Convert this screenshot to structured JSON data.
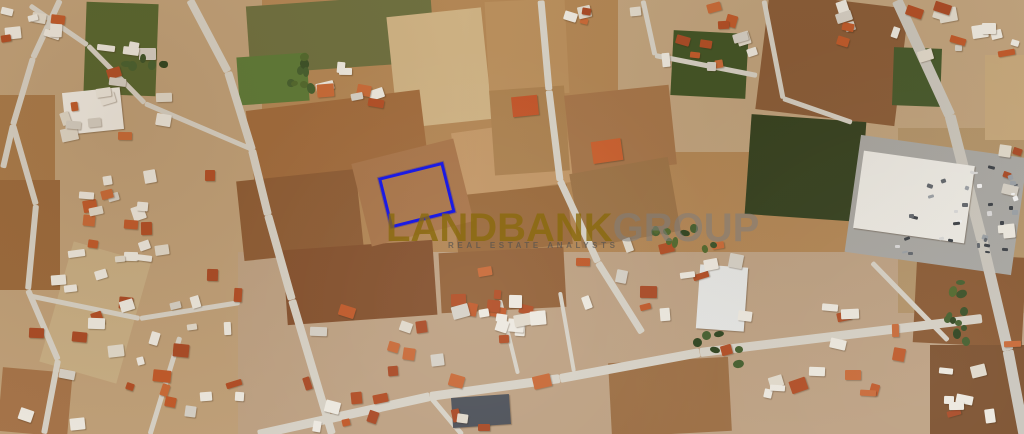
{
  "watermark": {
    "brand_primary": "LANDBANK",
    "brand_secondary": "GROUP",
    "tagline": "REAL ESTATE ANALYSTS",
    "primary_color": "rgba(138,106,12,0.8)",
    "secondary_color": "rgba(125,125,125,0.55)"
  },
  "annotation": {
    "plot_outline_color": "#1b1be4",
    "plot": {
      "x": 378,
      "y": 178,
      "w": 61,
      "h": 46,
      "r": -14
    }
  },
  "map": {
    "type": "satellite-aerial",
    "base_color": "#b28655",
    "road_color": "#d6d1c6",
    "fields": [
      {
        "x": 0,
        "y": 0,
        "w": 262,
        "h": 434,
        "r": 0,
        "c": "#bfa079"
      },
      {
        "x": 238,
        "y": 252,
        "w": 790,
        "h": 182,
        "r": 0,
        "c": "#bda183"
      },
      {
        "x": 618,
        "y": 0,
        "w": 406,
        "h": 152,
        "r": 0,
        "c": "#c0a37e"
      },
      {
        "x": 898,
        "y": 128,
        "w": 126,
        "h": 185,
        "r": 0,
        "c": "#b3946a"
      },
      {
        "x": 85,
        "y": 3,
        "w": 72,
        "h": 92,
        "r": 2,
        "c": "#55652f"
      },
      {
        "x": 0,
        "y": 95,
        "w": 55,
        "h": 85,
        "r": 0,
        "c": "#a87a4a"
      },
      {
        "x": 0,
        "y": 180,
        "w": 60,
        "h": 110,
        "r": 0,
        "c": "#9b6a3d",
        "tx": "rows-h"
      },
      {
        "x": 248,
        "y": 0,
        "w": 185,
        "h": 68,
        "r": -4,
        "c": "#6e7040"
      },
      {
        "x": 238,
        "y": 55,
        "w": 70,
        "h": 48,
        "r": -4,
        "c": "#5d7a38"
      },
      {
        "x": 392,
        "y": 12,
        "w": 95,
        "h": 112,
        "r": -6,
        "c": "#cdb183",
        "tx": "contour"
      },
      {
        "x": 487,
        "y": 0,
        "w": 80,
        "h": 95,
        "r": -3,
        "c": "#b98f5d"
      },
      {
        "x": 250,
        "y": 100,
        "w": 175,
        "h": 80,
        "r": -7,
        "c": "#a06b3d"
      },
      {
        "x": 240,
        "y": 175,
        "w": 120,
        "h": 80,
        "r": -6,
        "c": "#8d5c35",
        "tx": "rows-h"
      },
      {
        "x": 455,
        "y": 125,
        "w": 115,
        "h": 65,
        "r": -8,
        "c": "#c29767"
      },
      {
        "x": 492,
        "y": 88,
        "w": 75,
        "h": 85,
        "r": -4,
        "c": "#ab8150",
        "tx": "dots"
      },
      {
        "x": 455,
        "y": 190,
        "w": 115,
        "h": 60,
        "r": -6,
        "c": "#9a6a3c"
      },
      {
        "x": 285,
        "y": 245,
        "w": 150,
        "h": 75,
        "r": -4,
        "c": "#84512e"
      },
      {
        "x": 440,
        "y": 250,
        "w": 125,
        "h": 60,
        "r": -3,
        "c": "#936239"
      },
      {
        "x": 568,
        "y": 90,
        "w": 105,
        "h": 80,
        "r": -6,
        "c": "#a5754a"
      },
      {
        "x": 575,
        "y": 165,
        "w": 100,
        "h": 75,
        "r": -10,
        "c": "#9c7347",
        "tx": "contour"
      },
      {
        "x": 672,
        "y": 32,
        "w": 75,
        "h": 65,
        "r": 3,
        "c": "#415426"
      },
      {
        "x": 762,
        "y": 0,
        "w": 140,
        "h": 118,
        "r": 7,
        "c": "#8a5c38",
        "tx": "rows-v"
      },
      {
        "x": 748,
        "y": 118,
        "w": 115,
        "h": 100,
        "r": 4,
        "c": "#33401f"
      },
      {
        "x": 893,
        "y": 48,
        "w": 48,
        "h": 58,
        "r": 2,
        "c": "#46592c"
      },
      {
        "x": 985,
        "y": 55,
        "w": 39,
        "h": 85,
        "r": 0,
        "c": "#c6a87c"
      },
      {
        "x": 55,
        "y": 250,
        "w": 80,
        "h": 125,
        "r": 16,
        "c": "#c7ae85",
        "tx": "rows-h"
      },
      {
        "x": 0,
        "y": 370,
        "w": 70,
        "h": 64,
        "r": 5,
        "c": "#a5744a"
      },
      {
        "x": 915,
        "y": 255,
        "w": 109,
        "h": 90,
        "r": 3,
        "c": "#8a5a34"
      },
      {
        "x": 930,
        "y": 345,
        "w": 94,
        "h": 89,
        "r": 0,
        "c": "#7d5230",
        "tx": "rows-v"
      },
      {
        "x": 610,
        "y": 360,
        "w": 120,
        "h": 74,
        "r": -3,
        "c": "#9c6f45"
      },
      {
        "x": 360,
        "y": 150,
        "w": 105,
        "h": 85,
        "r": -14,
        "c": "#a8754a",
        "tx": "rows-v"
      },
      {
        "x": 852,
        "y": 146,
        "w": 168,
        "h": 118,
        "r": 8,
        "c": "#a8a7a3"
      }
    ],
    "roads": [
      {
        "x1": 190,
        "y1": 0,
        "x2": 228,
        "y2": 72,
        "t": 8
      },
      {
        "x1": 228,
        "y1": 72,
        "x2": 252,
        "y2": 150,
        "t": 8
      },
      {
        "x1": 252,
        "y1": 150,
        "x2": 268,
        "y2": 215,
        "t": 8
      },
      {
        "x1": 268,
        "y1": 215,
        "x2": 292,
        "y2": 300,
        "t": 8
      },
      {
        "x1": 292,
        "y1": 300,
        "x2": 332,
        "y2": 434,
        "t": 8
      },
      {
        "x1": 541,
        "y1": 0,
        "x2": 549,
        "y2": 90,
        "t": 7
      },
      {
        "x1": 549,
        "y1": 90,
        "x2": 560,
        "y2": 180,
        "t": 7
      },
      {
        "x1": 560,
        "y1": 180,
        "x2": 598,
        "y2": 262,
        "t": 7
      },
      {
        "x1": 598,
        "y1": 262,
        "x2": 642,
        "y2": 332,
        "t": 7
      },
      {
        "x1": 897,
        "y1": 0,
        "x2": 950,
        "y2": 115,
        "t": 11,
        "c": "#cac6bd"
      },
      {
        "x1": 950,
        "y1": 115,
        "x2": 982,
        "y2": 240,
        "t": 11,
        "c": "#cac6bd"
      },
      {
        "x1": 982,
        "y1": 240,
        "x2": 1008,
        "y2": 350,
        "t": 11,
        "c": "#cac6bd"
      },
      {
        "x1": 1008,
        "y1": 350,
        "x2": 1024,
        "y2": 434,
        "t": 11,
        "c": "#cac6bd"
      },
      {
        "x1": 258,
        "y1": 434,
        "x2": 430,
        "y2": 396,
        "t": 9
      },
      {
        "x1": 430,
        "y1": 396,
        "x2": 560,
        "y2": 378,
        "t": 9
      },
      {
        "x1": 560,
        "y1": 378,
        "x2": 700,
        "y2": 352,
        "t": 9
      },
      {
        "x1": 700,
        "y1": 352,
        "x2": 982,
        "y2": 318,
        "t": 9
      },
      {
        "x1": 430,
        "y1": 396,
        "x2": 462,
        "y2": 434,
        "t": 5
      },
      {
        "x1": 60,
        "y1": 0,
        "x2": 33,
        "y2": 58,
        "t": 6
      },
      {
        "x1": 33,
        "y1": 58,
        "x2": 13,
        "y2": 125,
        "t": 6
      },
      {
        "x1": 13,
        "y1": 125,
        "x2": 3,
        "y2": 168,
        "t": 6
      },
      {
        "x1": 30,
        "y1": 5,
        "x2": 88,
        "y2": 45,
        "t": 5
      },
      {
        "x1": 88,
        "y1": 45,
        "x2": 145,
        "y2": 103,
        "t": 5
      },
      {
        "x1": 145,
        "y1": 103,
        "x2": 250,
        "y2": 148,
        "t": 5
      },
      {
        "x1": 13,
        "y1": 125,
        "x2": 36,
        "y2": 205,
        "t": 6
      },
      {
        "x1": 36,
        "y1": 205,
        "x2": 28,
        "y2": 290,
        "t": 6
      },
      {
        "x1": 28,
        "y1": 290,
        "x2": 58,
        "y2": 360,
        "t": 6
      },
      {
        "x1": 58,
        "y1": 360,
        "x2": 44,
        "y2": 434,
        "t": 6
      },
      {
        "x1": 28,
        "y1": 295,
        "x2": 140,
        "y2": 318,
        "t": 5
      },
      {
        "x1": 140,
        "y1": 318,
        "x2": 240,
        "y2": 302,
        "t": 5
      },
      {
        "x1": 150,
        "y1": 434,
        "x2": 180,
        "y2": 336,
        "t": 5
      },
      {
        "x1": 643,
        "y1": 0,
        "x2": 655,
        "y2": 55,
        "t": 5
      },
      {
        "x1": 655,
        "y1": 55,
        "x2": 757,
        "y2": 75,
        "t": 5
      },
      {
        "x1": 764,
        "y1": 0,
        "x2": 783,
        "y2": 98,
        "t": 5
      },
      {
        "x1": 783,
        "y1": 98,
        "x2": 852,
        "y2": 122,
        "t": 5
      },
      {
        "x1": 500,
        "y1": 300,
        "x2": 518,
        "y2": 374,
        "t": 4
      },
      {
        "x1": 560,
        "y1": 292,
        "x2": 574,
        "y2": 372,
        "t": 4
      },
      {
        "x1": 872,
        "y1": 262,
        "x2": 948,
        "y2": 340,
        "t": 5
      }
    ],
    "buildings": [
      {
        "x": 858,
        "y": 158,
        "w": 112,
        "h": 78,
        "r": 8,
        "c": "#edebe5"
      },
      {
        "x": 698,
        "y": 266,
        "w": 48,
        "h": 64,
        "r": 4,
        "c": "#e4e5e3"
      },
      {
        "x": 452,
        "y": 396,
        "w": 58,
        "h": 30,
        "r": -4,
        "c": "#4e525a"
      },
      {
        "x": 64,
        "y": 90,
        "w": 58,
        "h": 42,
        "r": -6,
        "c": "#f0ede6"
      },
      {
        "x": 512,
        "y": 96,
        "w": 26,
        "h": 20,
        "r": -6,
        "c": "#c2552a"
      },
      {
        "x": 592,
        "y": 140,
        "w": 30,
        "h": 22,
        "r": -8,
        "c": "#c9602f"
      }
    ],
    "clusters": [
      {
        "x": 52,
        "y": 42,
        "w": 135,
        "h": 100,
        "n": 16,
        "seed": 7,
        "p": "houses"
      },
      {
        "x": 0,
        "y": 0,
        "w": 75,
        "h": 55,
        "n": 8,
        "seed": 11,
        "p": "houses"
      },
      {
        "x": 52,
        "y": 145,
        "w": 165,
        "h": 118,
        "n": 20,
        "seed": 13,
        "p": "houses"
      },
      {
        "x": 0,
        "y": 268,
        "w": 245,
        "h": 166,
        "n": 30,
        "seed": 17,
        "p": "houses"
      },
      {
        "x": 300,
        "y": 52,
        "w": 95,
        "h": 62,
        "n": 8,
        "seed": 19,
        "p": "houses"
      },
      {
        "x": 300,
        "y": 300,
        "w": 265,
        "h": 134,
        "n": 28,
        "seed": 23,
        "p": "houses"
      },
      {
        "x": 432,
        "y": 252,
        "w": 168,
        "h": 92,
        "n": 12,
        "seed": 29,
        "p": "houses"
      },
      {
        "x": 615,
        "y": 238,
        "w": 150,
        "h": 122,
        "n": 13,
        "seed": 31,
        "p": "houses"
      },
      {
        "x": 758,
        "y": 298,
        "w": 155,
        "h": 102,
        "n": 14,
        "seed": 37,
        "p": "houses"
      },
      {
        "x": 640,
        "y": 0,
        "w": 118,
        "h": 72,
        "n": 12,
        "seed": 41,
        "p": "houses"
      },
      {
        "x": 903,
        "y": 0,
        "w": 121,
        "h": 62,
        "n": 12,
        "seed": 43,
        "p": "houses"
      },
      {
        "x": 988,
        "y": 140,
        "w": 36,
        "h": 118,
        "n": 6,
        "seed": 47,
        "p": "houses"
      },
      {
        "x": 938,
        "y": 338,
        "w": 86,
        "h": 96,
        "n": 8,
        "seed": 53,
        "p": "houses"
      },
      {
        "x": 818,
        "y": 0,
        "w": 86,
        "h": 46,
        "n": 6,
        "seed": 59,
        "p": "houses"
      },
      {
        "x": 553,
        "y": 0,
        "w": 88,
        "h": 36,
        "n": 5,
        "seed": 61,
        "p": "houses"
      },
      {
        "x": 283,
        "y": 52,
        "w": 32,
        "h": 52,
        "n": 8,
        "seed": 67,
        "p": "trees"
      },
      {
        "x": 648,
        "y": 222,
        "w": 70,
        "h": 34,
        "n": 9,
        "seed": 71,
        "p": "trees"
      },
      {
        "x": 938,
        "y": 272,
        "w": 48,
        "h": 108,
        "n": 12,
        "seed": 73,
        "p": "trees"
      },
      {
        "x": 118,
        "y": 52,
        "w": 52,
        "h": 32,
        "n": 6,
        "seed": 83,
        "p": "trees"
      },
      {
        "x": 690,
        "y": 330,
        "w": 60,
        "h": 40,
        "n": 6,
        "seed": 101,
        "p": "trees"
      },
      {
        "x": 976,
        "y": 150,
        "w": 44,
        "h": 104,
        "n": 14,
        "seed": 89,
        "p": "cars"
      },
      {
        "x": 880,
        "y": 236,
        "w": 118,
        "h": 24,
        "n": 10,
        "seed": 97,
        "p": "cars"
      },
      {
        "x": 900,
        "y": 170,
        "w": 90,
        "h": 60,
        "n": 12,
        "seed": 103,
        "p": "cars"
      }
    ],
    "palettes": {
      "houses": [
        "#ece8df",
        "#e0d9cb",
        "#ece8df",
        "#c05a2b",
        "#b14e26",
        "#d5d0c6",
        "#c86a38",
        "#ece8df",
        "#a94b27"
      ],
      "trees": [
        "#3a5128",
        "#455f2f",
        "#2f4420",
        "#51682e"
      ],
      "cars": [
        "#f2f2f2",
        "#d9d9d9",
        "#61666d",
        "#9aa0a6",
        "#3c4147"
      ]
    }
  }
}
